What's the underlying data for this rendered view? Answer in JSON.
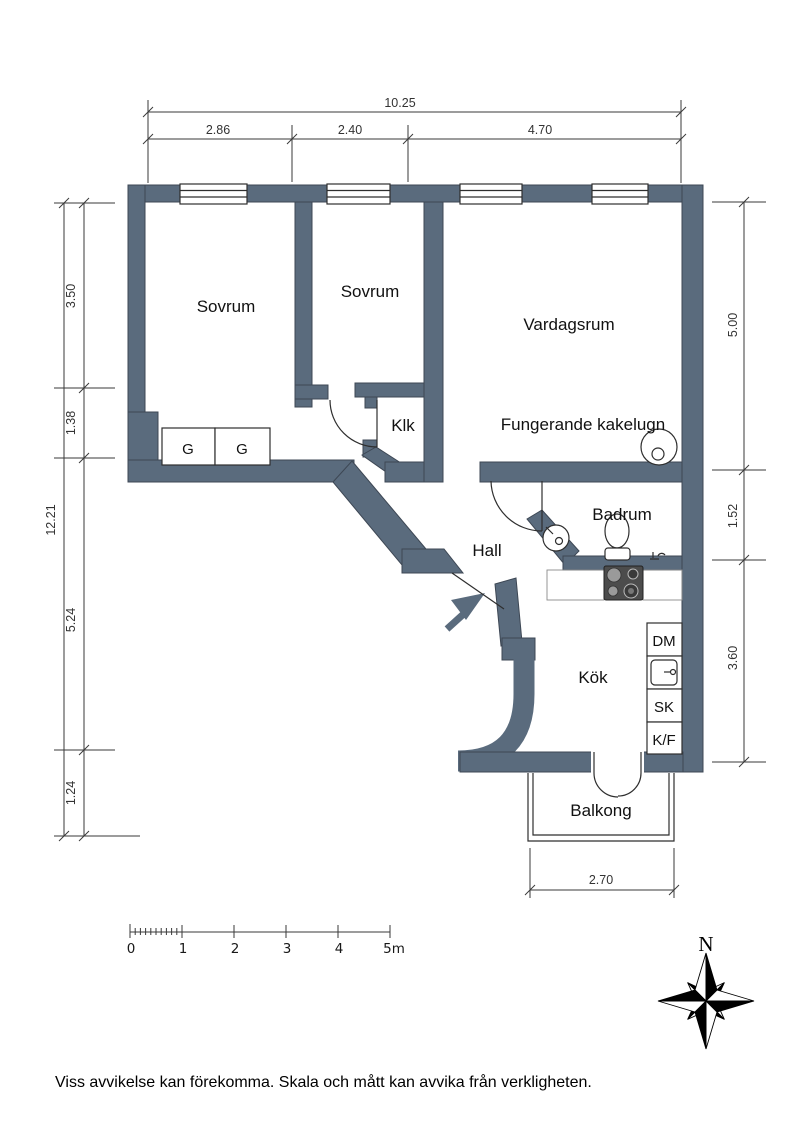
{
  "colors": {
    "wall": "#5a6b7d",
    "background": "#ffffff"
  },
  "rooms": {
    "sovrum1": "Sovrum",
    "sovrum2": "Sovrum",
    "vardagsrum": "Vardagsrum",
    "klk": "Klk",
    "hall": "Hall",
    "badrum": "Badrum",
    "kok": "Kök",
    "balkong": "Balkong"
  },
  "features": {
    "kakelugn_note": "Fungerande kakelugn",
    "wardrobe_left": "G",
    "wardrobe_right": "G",
    "dishwasher": "DM",
    "cabinet": "SK",
    "fridge_freezer": "K/F"
  },
  "dimensions": {
    "top_total": "10.25",
    "top_segments": [
      "2.86",
      "2.40",
      "4.70"
    ],
    "left_total": "12.21",
    "left_segments": [
      "3.50",
      "1.38",
      "5.24",
      "1.24"
    ],
    "right_segments": [
      "5.00",
      "1.52",
      "3.60"
    ],
    "balcony_width": "2.70"
  },
  "scale_bar": {
    "labels": [
      "0",
      "1",
      "2",
      "3",
      "4",
      "5m"
    ]
  },
  "compass": {
    "north": "N"
  },
  "footer": {
    "disclaimer": "Viss avvikelse kan förekomma. Skala och mått kan avvika från verkligheten."
  }
}
